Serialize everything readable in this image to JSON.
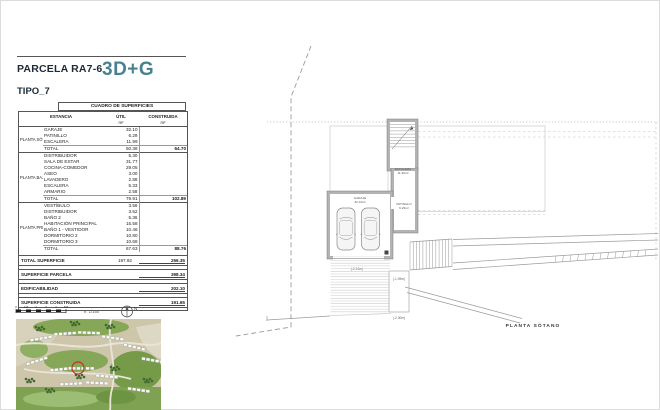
{
  "header": {
    "title": "PARCELA RA7-6",
    "logo": "3D+G",
    "type": "TIPO_7"
  },
  "colors": {
    "accent_teal": "#47828f",
    "heading": "#1d2b38",
    "site_marker_red": "#c03028"
  },
  "table": {
    "title": "CUADRO DE SUPERFICIES",
    "columns": {
      "estancia": "ESTANCIA",
      "util": "ÚTIL",
      "construida": "CONSTRUIDA",
      "unit": "m²"
    },
    "sections": [
      {
        "floor": "PLANTA SÓTANO",
        "rows": [
          {
            "name": "GARAJE",
            "util": "32.10"
          },
          {
            "name": "PATINILLO",
            "util": "6.29"
          },
          {
            "name": "ESCALERA",
            "util": "11.99"
          }
        ],
        "total": {
          "label": "TOTAL",
          "util": "50.38",
          "construida": "64.70"
        }
      },
      {
        "floor": "PLANTA BAJA",
        "rows": [
          {
            "name": "DISTRIBUIDOR",
            "util": "5.30"
          },
          {
            "name": "SALA DE ESTAR",
            "util": "31.77"
          },
          {
            "name": "COCINA-COMEDOR",
            "util": "29.05"
          },
          {
            "name": "ASEO",
            "util": "3.00"
          },
          {
            "name": "LAVADERO",
            "util": "2.88"
          },
          {
            "name": "ESCALERA",
            "util": "5.33"
          },
          {
            "name": "ARMARIO",
            "util": "2.58"
          }
        ],
        "total": {
          "label": "TOTAL",
          "util": "79.91",
          "construida": "102.89"
        }
      },
      {
        "floor": "PLANTA PRIMERA",
        "rows": [
          {
            "name": "VESTÍBULO",
            "util": "3.56"
          },
          {
            "name": "DISTRIBUIDOR",
            "util": "3.52"
          },
          {
            "name": "BAÑO 2",
            "util": "5.36"
          },
          {
            "name": "HABITACIÓN PRINCIPAL",
            "util": "15.58"
          },
          {
            "name": "BAÑO 1 - VESTIDOR",
            "util": "10.46"
          },
          {
            "name": "DORMITORIO 2",
            "util": "10.80"
          },
          {
            "name": "DORMITORIO 3",
            "util": "10.68"
          }
        ],
        "total": {
          "label": "TOTAL",
          "util": "67.63",
          "construida": "88.76"
        }
      }
    ],
    "summary": [
      {
        "label": "TOTAL SUPERFICIE",
        "util": "197.92",
        "construida": "256.35"
      },
      {
        "label": "SUPERFICIE PARCELA",
        "util": "",
        "construida": "398.34"
      },
      {
        "label": "EDIFICABILIDAD",
        "util": "",
        "construida": "202.10"
      },
      {
        "label": "SUPERFICIE CONSTRUIDA",
        "util": "",
        "construida": "191.65"
      }
    ]
  },
  "plan": {
    "title": "PLANTA SÓTANO",
    "rooms": [
      {
        "label": "GARAJE",
        "area": "32.10m²"
      },
      {
        "label": "PATINILLO",
        "area": "6.29m²"
      },
      {
        "label": "ESCALERA",
        "area": "11.99m²"
      }
    ],
    "levels": [
      "(-2.13m)",
      "(-1.09m)",
      "(-2.30m)"
    ]
  },
  "footer": {
    "scale": "e. 1/150",
    "north": "N",
    "ticks": [
      "0",
      "1M",
      "2",
      "3",
      "4",
      "5M"
    ]
  }
}
